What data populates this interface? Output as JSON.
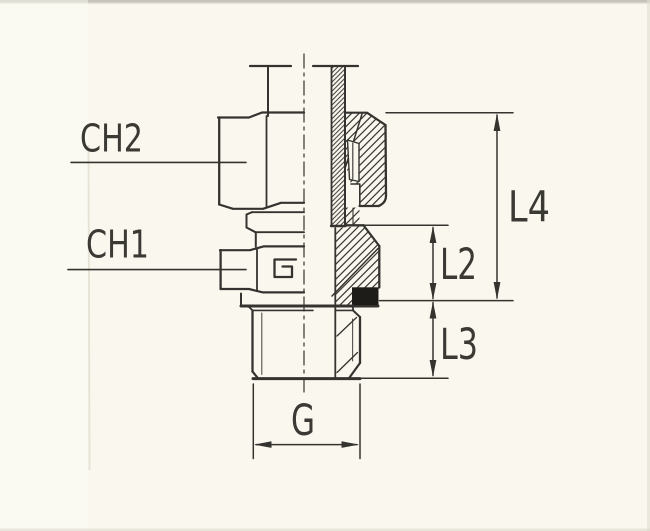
{
  "drawing": {
    "labels": {
      "ch2": "CH2",
      "ch1": "CH1",
      "l4": "L4",
      "l2": "L2",
      "l3": "L3",
      "g": "G"
    },
    "colors": {
      "ink": "#35332f",
      "paper": "#faf8ee",
      "label_text": "#3b3934",
      "seal_fill": "#1e1c19"
    }
  }
}
